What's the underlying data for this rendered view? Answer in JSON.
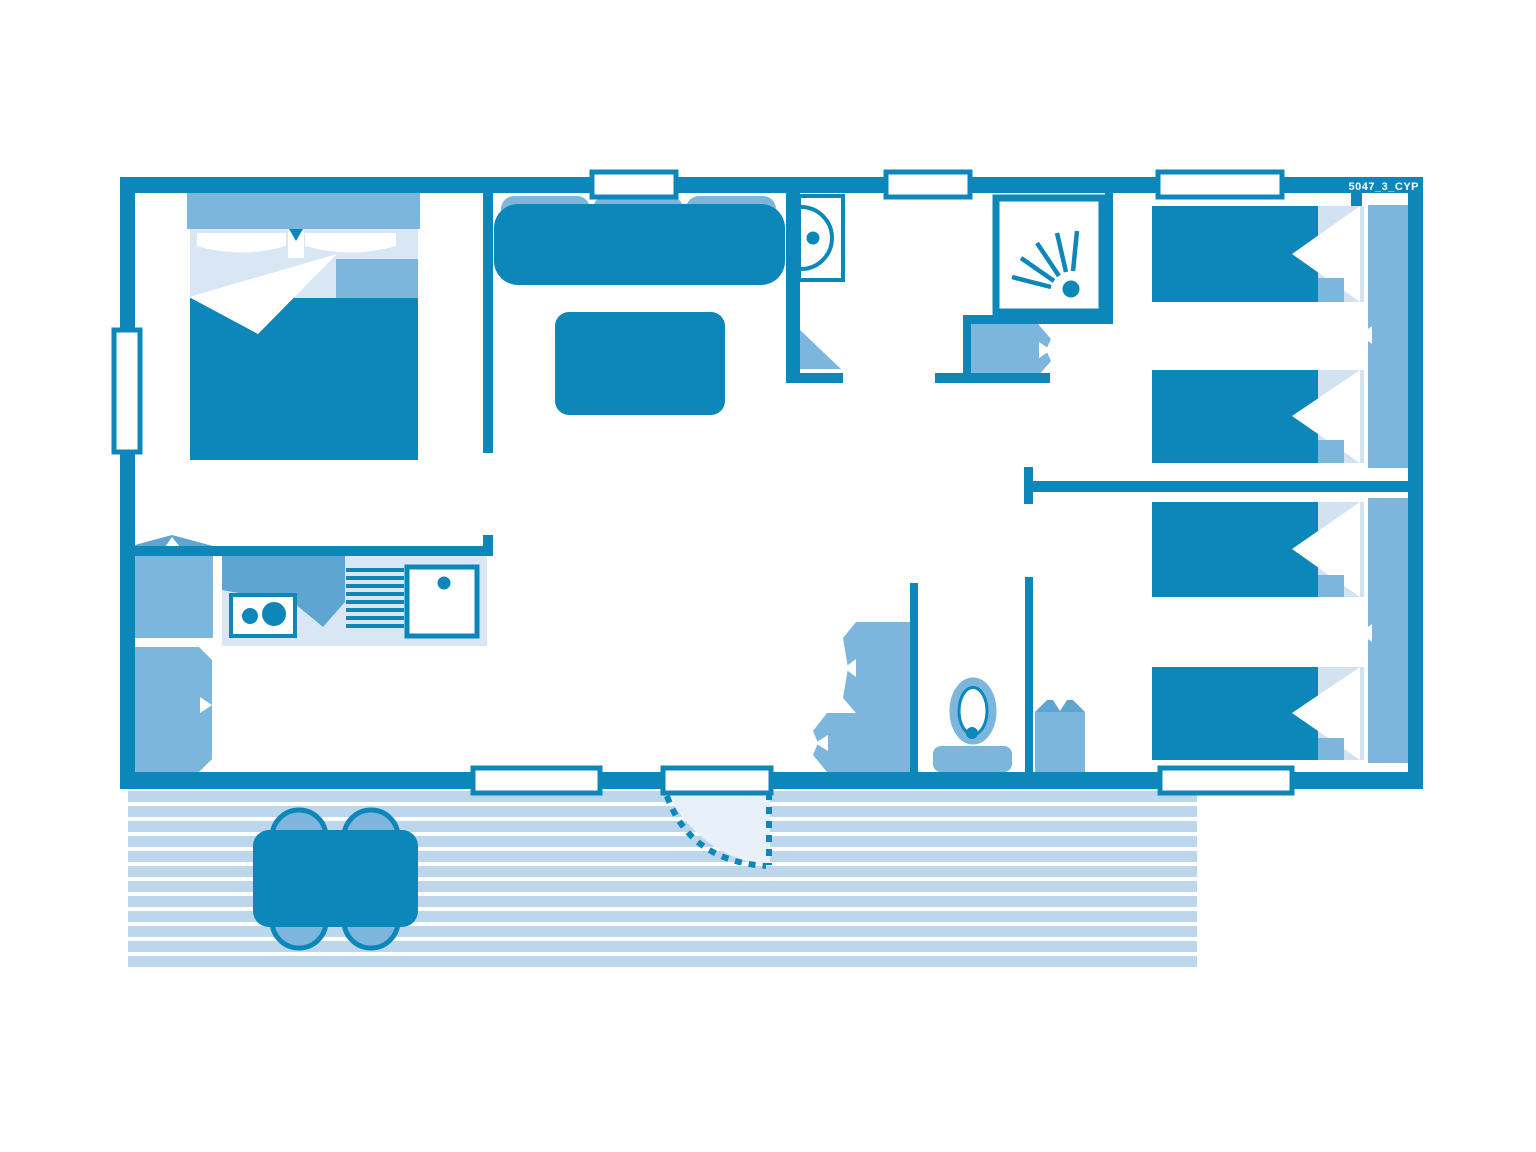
{
  "plan": {
    "code": "5047_3_CYP"
  },
  "colors": {
    "c-dark": "#0d86ba",
    "c-med": "#7cb6dc",
    "c-med2": "#5fa5d1",
    "c-light": "#d9e6f4",
    "c-lighter": "#d3e2f1",
    "c-deck": "#bcd6ec",
    "c-swing": "#e8f1f9",
    "background": "#ffffff"
  }
}
